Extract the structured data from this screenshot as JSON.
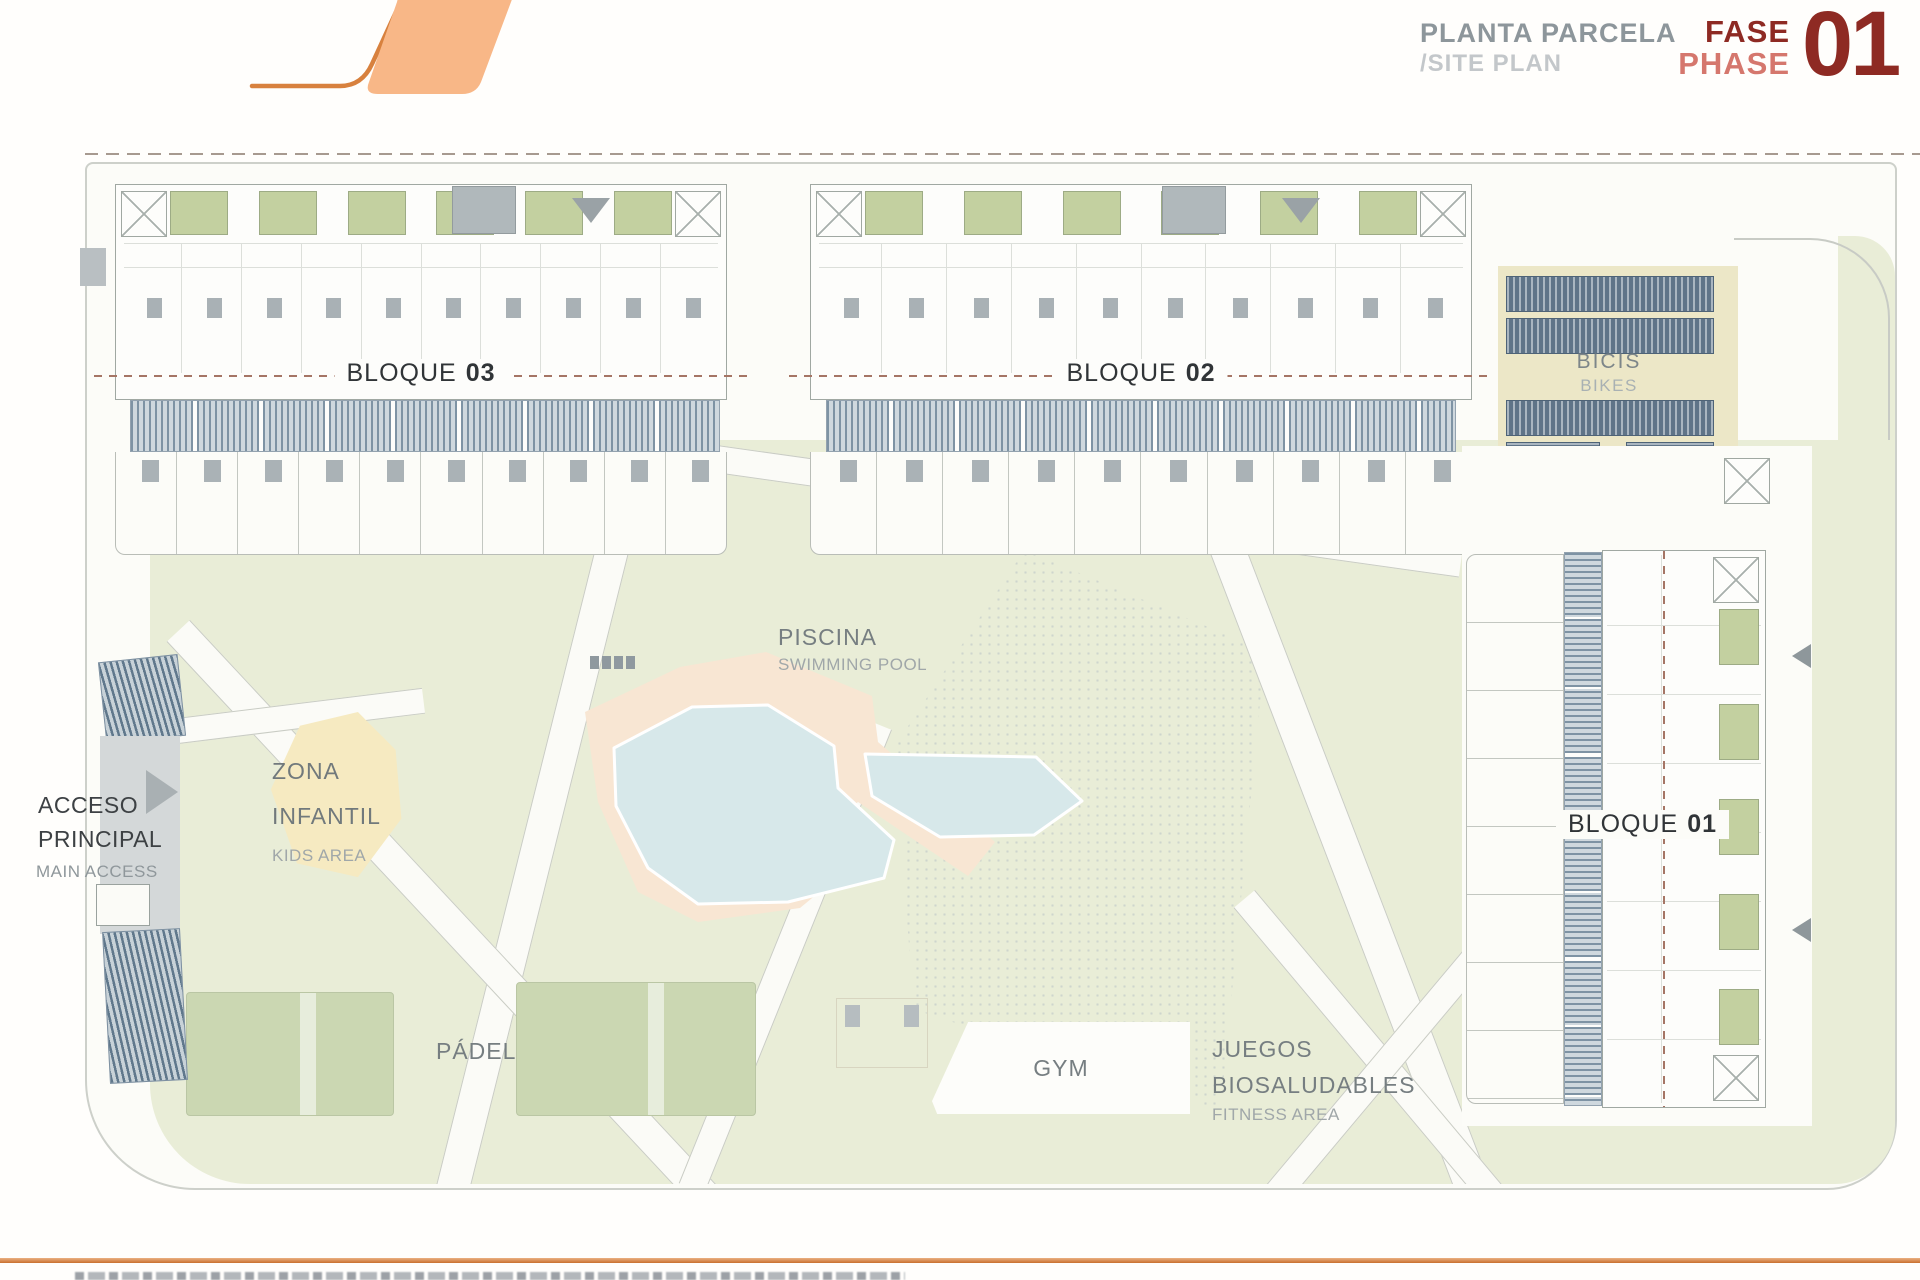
{
  "header": {
    "title": "PLANTA PARCELA",
    "subtitle": "/SITE PLAN",
    "phase_label_es": "FASE",
    "phase_label_en": "PHASE",
    "phase_number": "01"
  },
  "plan": {
    "blocks": [
      {
        "label": "BLOQUE",
        "number": "03"
      },
      {
        "label": "BLOQUE",
        "number": "02"
      },
      {
        "label": "BLOQUE",
        "number": "01"
      }
    ],
    "areas": {
      "bikes": {
        "name_es": "BICIS",
        "name_en": "BIKES"
      },
      "pool": {
        "name_es": "PISCINA",
        "name_en": "SWIMMING POOL"
      },
      "kids": {
        "name_es_line1": "ZONA",
        "name_es_line2": "INFANTIL",
        "name_en": "KIDS AREA"
      },
      "access": {
        "name_es_line1": "ACCESO",
        "name_es_line2": "PRINCIPAL",
        "name_en": "MAIN ACCESS"
      },
      "padel": {
        "name_es": "PÁDEL"
      },
      "gym": {
        "name_es": "GYM"
      },
      "fitness": {
        "name_es_line1": "JUEGOS",
        "name_es_line2": "BIOSALUDABLES",
        "name_en": "FITNESS AREA"
      }
    },
    "colors": {
      "phase_red": "#8e2a23",
      "phase_salmon": "#d5776d",
      "title_gray": "#8d969b",
      "subtitle_gray": "#c3c7ca",
      "logo_fill": "#f8b787",
      "logo_stroke": "#d8813e",
      "landscape_green": "#e9edd7",
      "court_green": "#cbd7b2",
      "patio_green": "#c3d0a0",
      "pool_water": "#d7e8ea",
      "pool_deck": "#f8e6d3",
      "kids_yellow": "#f6eac1",
      "bikes_beige": "#ece7c7",
      "rack_blue": "#5f7488",
      "dash_brown": "#a57565",
      "bottom_rule_orange": "#c96f2e"
    }
  }
}
